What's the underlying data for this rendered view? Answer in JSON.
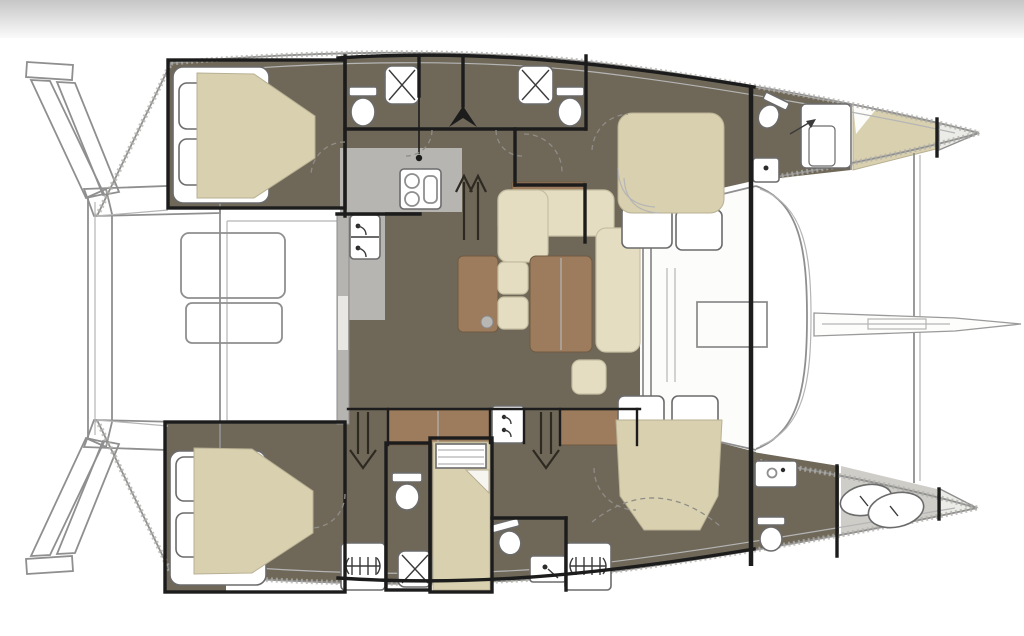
{
  "meta": {
    "description": "Catamaran sailing yacht interior layout floor plan, top-down view, bows pointing right, twin hulls with central salon",
    "diagram_type": "floor-plan"
  },
  "colors": {
    "page_bg": "#ffffff",
    "top_bar_start": "#c6c6c6",
    "top_bar_end": "#fafafa",
    "outline": "#8f8f8f",
    "outline_light": "#b5b5b5",
    "wall": "#1c1c1c",
    "floor_dark": "#6f6859",
    "floor_gray": "#b7b5b1",
    "floor_gray_light": "#cfcdc8",
    "mattress": "#d9d0af",
    "sofa": "#e5ddc2",
    "wood": "#9c7c5c",
    "wood_light": "#c9b797",
    "fixture": "#ffffff",
    "fixture_stroke": "#6b6b6b",
    "deck_white": "#fcfcfb",
    "bow_tip": "#ebebe7",
    "arrow": "#2e2a22"
  },
  "rooms": [
    {
      "id": "aft-cabin-top",
      "label": "Aft double cabin, upper hull"
    },
    {
      "id": "head-top-aft",
      "label": "Bathroom with shower and toilet, upper hull aft"
    },
    {
      "id": "head-top-mid",
      "label": "Bathroom with shower and toilet, upper hull mid"
    },
    {
      "id": "fwd-cabin-top",
      "label": "Forward double cabin, upper hull"
    },
    {
      "id": "fwd-head-top",
      "label": "Forward bathroom, upper hull bow"
    },
    {
      "id": "bow-berth-top",
      "label": "Bow berth forepeak, upper hull"
    },
    {
      "id": "salon",
      "label": "Salon with sofa, chairs and table"
    },
    {
      "id": "galley",
      "label": "Galley with stove and sink"
    },
    {
      "id": "cockpit",
      "label": "Aft cockpit with table and bench"
    },
    {
      "id": "aft-cabin-bottom",
      "label": "Aft double cabin, lower hull"
    },
    {
      "id": "head-bottom-left",
      "label": "Bathroom with toilet and shower, lower hull"
    },
    {
      "id": "single-berth-bottom",
      "label": "Mid single berth, lower hull"
    },
    {
      "id": "head-bottom-right",
      "label": "Bathroom with toilet and sink, lower hull"
    },
    {
      "id": "fwd-cabin-bottom",
      "label": "Forward double cabin, lower hull"
    },
    {
      "id": "fwd-head-bottom",
      "label": "Forward bathroom, lower hull bow"
    },
    {
      "id": "forepeak-bottom",
      "label": "Forepeak locker, lower hull bow"
    }
  ],
  "fixtures": [
    "toilet",
    "shower",
    "sink",
    "faucet",
    "stove-burners",
    "double-berth",
    "single-berth",
    "pillows",
    "sofa",
    "coffee-table",
    "armchair-cushions",
    "cockpit-table",
    "cockpit-bench",
    "stairs-up-arrow",
    "stairs-down-arrow",
    "companionway-ladder",
    "mast-step-hatch",
    "bowsprit",
    "forward-crossbeam",
    "trampoline-edge",
    "stern-steps",
    "aft-davit-beam",
    "door-swing-arc",
    "bulkhead",
    "sail-bags"
  ]
}
